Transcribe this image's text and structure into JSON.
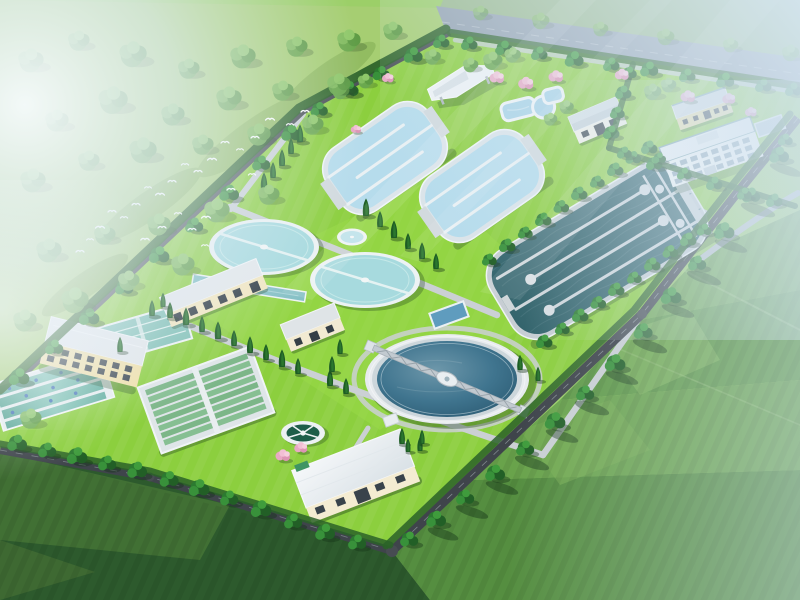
{
  "scene": {
    "title": "Aerial 3D rendering of a wastewater treatment plant campus surrounded by green fields",
    "type": "architectural-visualization",
    "view": "bird's-eye, isometric-like perspective",
    "atmosphere": {
      "mist": "white-blue haze over top-left meadow and top-right corner",
      "sun_rays": "faint diagonal light streaks from upper right",
      "birds": "flock of small white birds over the meadow, top-left"
    },
    "surroundings": {
      "top_left": "hazy meadow with scattered broadleaf trees",
      "top_edge": "gray-blue perimeter road band lined with trees",
      "bottom_left": "dark green crop fields",
      "bottom_right": "patchwork of bright and mid-green farm fields with tree shadows"
    },
    "facilities": [
      {
        "name": "aeration-basin-1",
        "desc": "light-blue serpentine aeration basin, rounded rectangle, upper middle"
      },
      {
        "name": "aeration-basin-2",
        "desc": "light-blue serpentine aeration basin, rounded rectangle, right of basin 1"
      },
      {
        "name": "oxidation-ditch",
        "desc": "large dark-teal serpentine oxidation ditch with pale channel walls and rounded end caps, right-center"
      },
      {
        "name": "clarifier-small-1",
        "desc": "small circular clarifier, aqua water, white rim, diametral bridge"
      },
      {
        "name": "clarifier-small-2",
        "desc": "small circular clarifier, aqua water, white rim, diametral bridge"
      },
      {
        "name": "dosing-pond",
        "desc": "tiny round pond between small clarifiers"
      },
      {
        "name": "clarifier-large",
        "desc": "large circular clarifier, deep blue water, concentric white rings, gray truss scraper bridge"
      },
      {
        "name": "sedimentation-tanks",
        "desc": "four parallel teal lanes with white divider walls and blue scraper units, lower left"
      },
      {
        "name": "filter-basin",
        "desc": "large rectangular basin with many narrow green-teal lanes and central walkway"
      },
      {
        "name": "rectangular-basin",
        "desc": "teal rectangular basin with lane stripes beside pump house"
      },
      {
        "name": "inlet-channel",
        "desc": "narrow teal channel behind workshop building"
      },
      {
        "name": "equalization-pool",
        "desc": "small blue rectangular pool southwest of oxidation ditch"
      },
      {
        "name": "fountain-tank",
        "desc": "small circular dark-green tank with white ring walkway and radial spokes"
      },
      {
        "name": "pump-house",
        "desc": "yellow two-story building, flat gray roof, left edge"
      },
      {
        "name": "workshop-building",
        "desc": "long cream single-story building with gray roof, center-left"
      },
      {
        "name": "substation-building",
        "desc": "small cream building with gray roof near center"
      },
      {
        "name": "blower-building",
        "desc": "white building with gray roof beside aeration basins"
      },
      {
        "name": "pavilion-canopy",
        "desc": "white angular shade canopy structure, top area"
      },
      {
        "name": "ornamental-pool",
        "desc": "irregular white-rimmed light-blue pool near pavilion"
      },
      {
        "name": "admin-annex",
        "desc": "small yellow building with gray roof, top right"
      },
      {
        "name": "office-building",
        "desc": "white three-story office block with window grid and teal-trimmed roof, top right"
      },
      {
        "name": "maintenance-building",
        "desc": "cream building with large white sloped roof, bottom center"
      }
    ],
    "vegetation": {
      "boundary": "dense dark hedge rows and round trees along all site roads",
      "interior": "columnar cypress rows along walkways",
      "accent": "pink flowering trees near pavilion, admin lawn and fountain"
    },
    "counts": {
      "small_clarifiers": 2,
      "large_clarifiers": 1,
      "serpentine_basins": 3,
      "buildings": 9,
      "birds": 26
    },
    "palette": {
      "site_grass": "#8ccf3e",
      "meadow": "#a6ce72",
      "field_dark": "#2d5a2d",
      "field_mid": "#5f9a46",
      "water_light": "#b6dcec",
      "water_aqua": "#a7dade",
      "water_deep": "#2b5a72",
      "water_ditch": "#33646c",
      "water_teal_lane": "#5cab9b",
      "concrete_white": "#eef2f4",
      "road_dark": "#3f444b",
      "path_light": "#cbd0d4",
      "building_yellow": "#f1e0a8",
      "building_cream": "#f4ecd2",
      "roof_gray": "#dfe4e7",
      "tree_dark": "#1d5c24",
      "tree_round": "#2c7a30",
      "pink_blossom": "#e8a8c4",
      "mist": "#e3eef8",
      "haze_blue": "#d7e7f5"
    }
  }
}
